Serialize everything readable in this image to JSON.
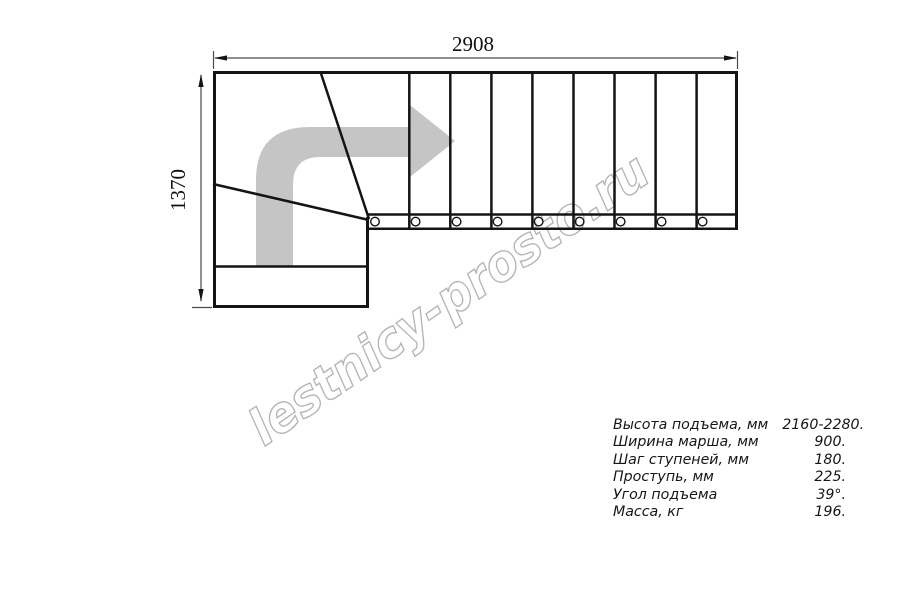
{
  "drawing": {
    "width_dimension": "2908",
    "height_dimension": "1370"
  },
  "watermark": {
    "text": "lestnicy-prosto.ru",
    "color": "#b5b5b5"
  },
  "specs": {
    "rows": [
      {
        "label": "Высота подъема, мм",
        "value": "2160-2280."
      },
      {
        "label": "Ширина марша, мм",
        "value": "900."
      },
      {
        "label": "Шаг ступеней, мм",
        "value": "180."
      },
      {
        "label": "Проступь, мм",
        "value": "225."
      },
      {
        "label": "Угол подъема",
        "value": "39°."
      },
      {
        "label": "Масса, кг",
        "value": "196."
      }
    ]
  },
  "colors": {
    "line": "#141414",
    "arrow_fill": "#c5c5c5",
    "dimension_line": "#4a4a4a"
  }
}
